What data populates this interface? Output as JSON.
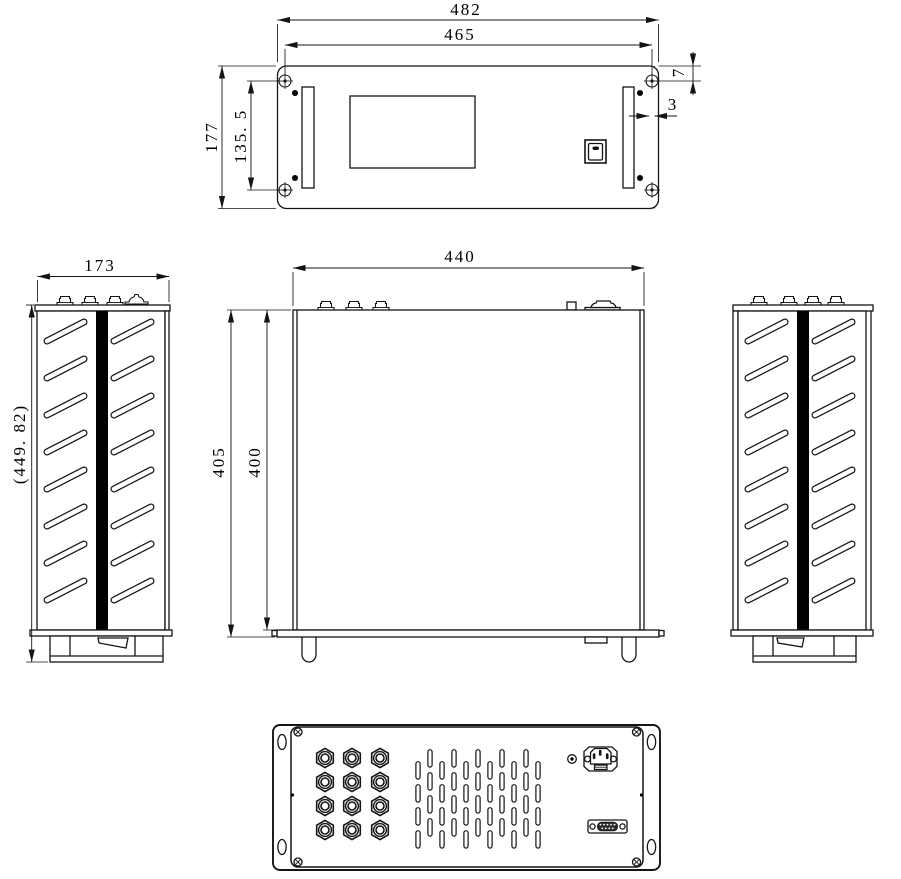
{
  "drawing": {
    "front": {
      "overall_width": "482",
      "mounting_width": "465",
      "panel_height": "177",
      "hole_spacing": "135. 5",
      "flange_offset": "7",
      "flange_gap": "3"
    },
    "side": {
      "depth": "173",
      "overall_height": "(449. 82)"
    },
    "top": {
      "body_width": "440",
      "overall_depth": "405",
      "body_depth": "400"
    }
  }
}
